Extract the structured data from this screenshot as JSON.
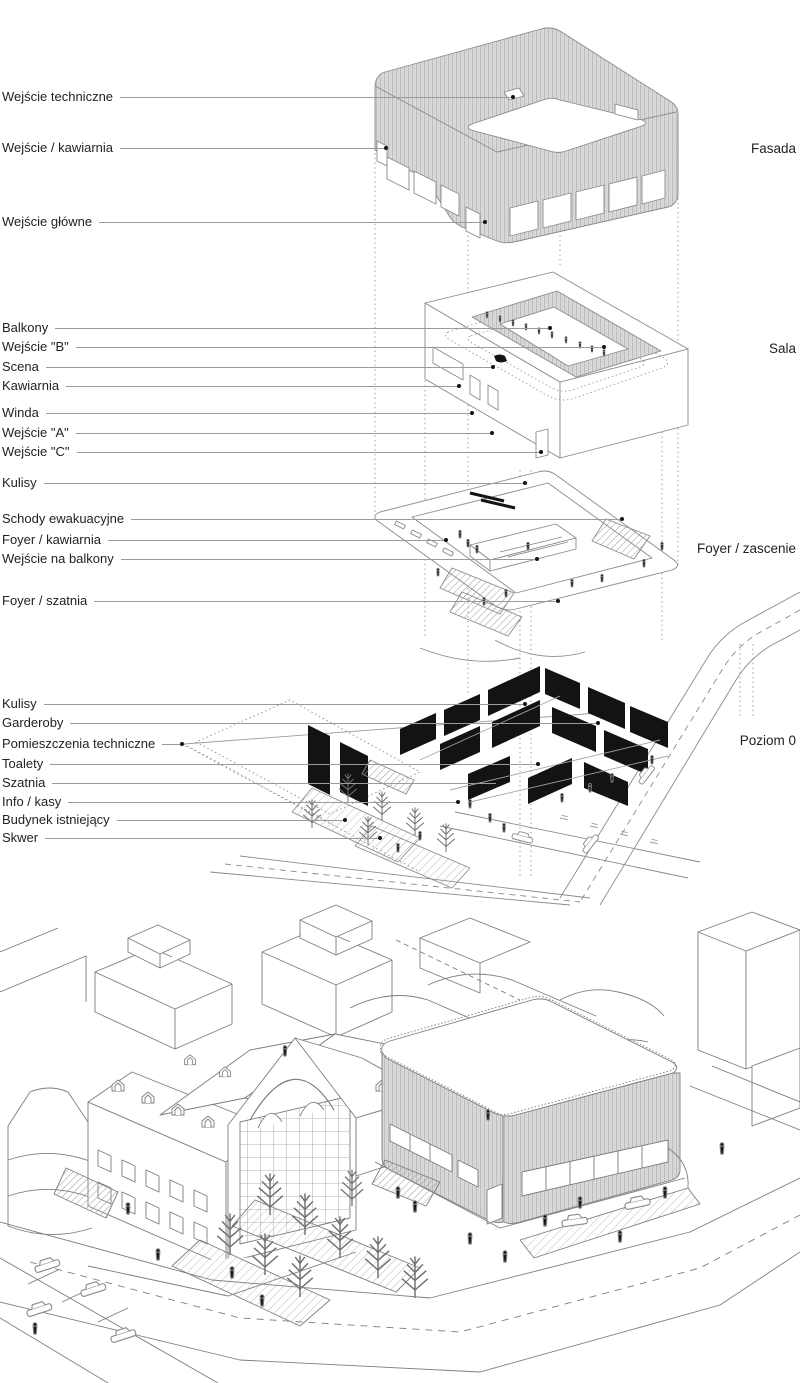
{
  "diagram": {
    "levels": [
      {
        "label": "Fasada"
      },
      {
        "label": "Sala"
      },
      {
        "label": "Foyer / zascenie"
      },
      {
        "label": "Poziom 0"
      }
    ],
    "callouts": [
      {
        "label": "Wejście techniczne"
      },
      {
        "label": "Wejście / kawiarnia"
      },
      {
        "label": "Wejście główne"
      },
      {
        "label": "Balkony"
      },
      {
        "label": "Wejście \"B\""
      },
      {
        "label": "Scena"
      },
      {
        "label": "Kawiarnia"
      },
      {
        "label": "Winda"
      },
      {
        "label": "Wejście \"A\""
      },
      {
        "label": "Wejście \"C\""
      },
      {
        "label": "Kulisy"
      },
      {
        "label": "Schody ewakuacyjne"
      },
      {
        "label": "Foyer / kawiarnia"
      },
      {
        "label": "Wejście na balkony"
      },
      {
        "label": "Foyer / szatnia"
      },
      {
        "label": "Kulisy"
      },
      {
        "label": "Garderoby"
      },
      {
        "label": "Pomieszczenia techniczne"
      },
      {
        "label": "Toalety"
      },
      {
        "label": "Szatnia"
      },
      {
        "label": "Info / kasy"
      },
      {
        "label": "Budynek istniejący"
      },
      {
        "label": "Skwer"
      }
    ],
    "colors": {
      "background": "#ffffff",
      "text": "#222222",
      "leader_line": "#9b9b9b",
      "drawing_line": "#858585",
      "facade_fill": "#dcdcdc",
      "facade_stripe": "#bdbdbd",
      "wall_poche": "#131313"
    }
  }
}
